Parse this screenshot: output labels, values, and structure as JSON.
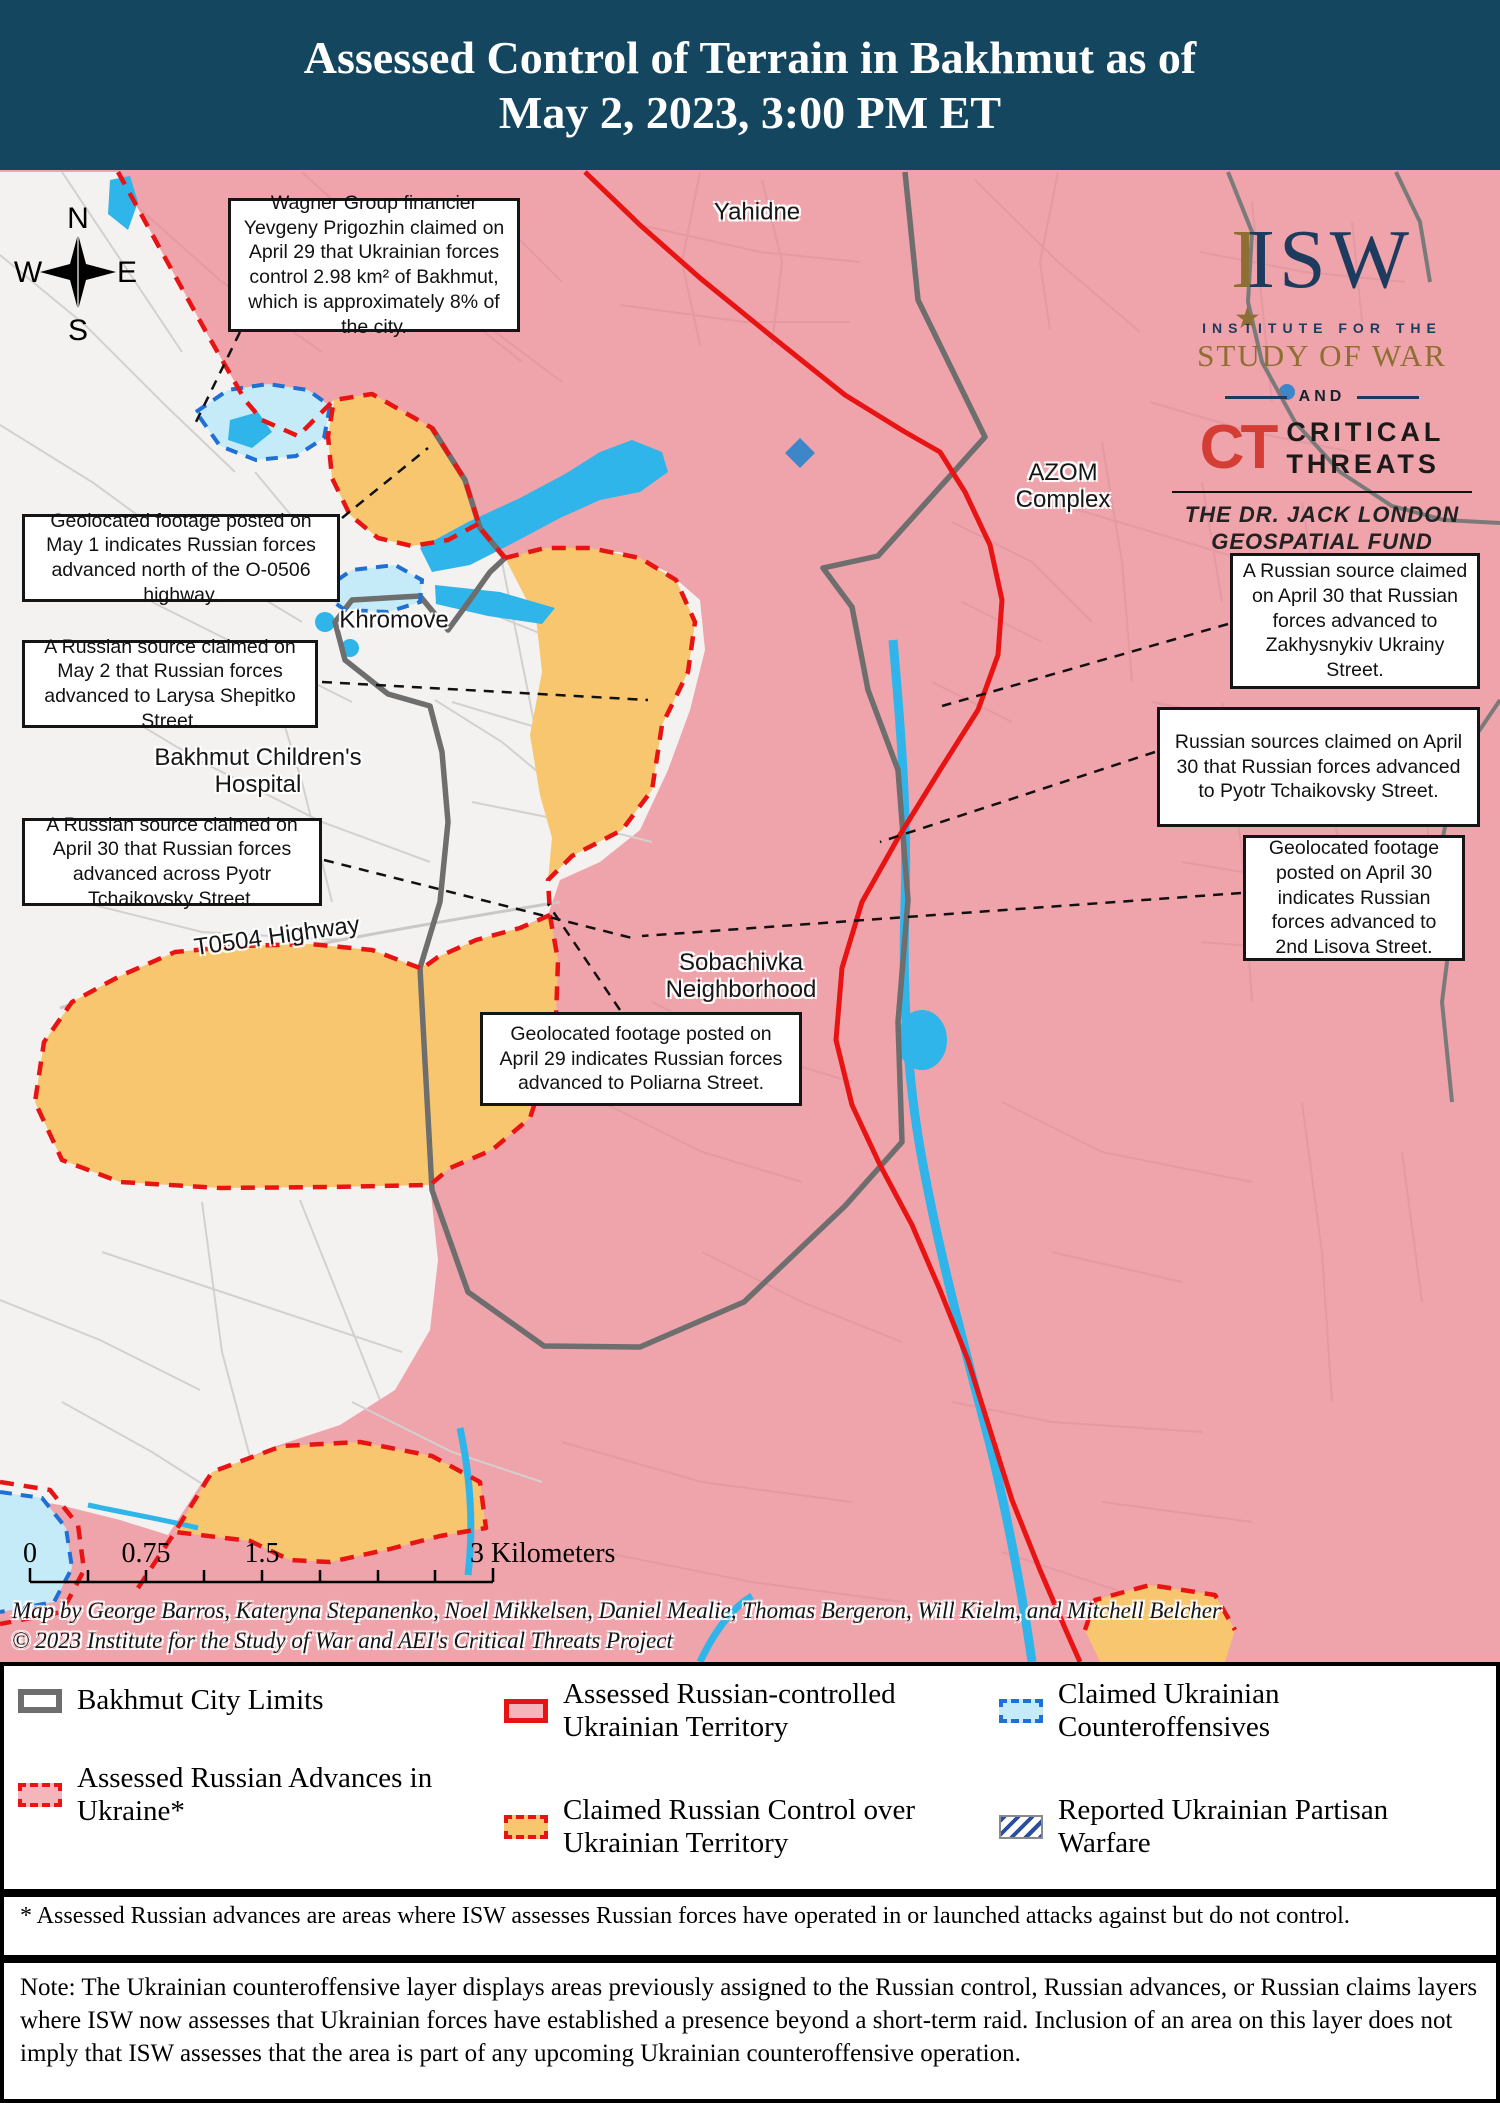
{
  "header": {
    "title_line1": "Assessed Control of Terrain in Bakhmut as of",
    "title_line2": "May 2, 2023, 3:00 PM ET"
  },
  "logo": {
    "isw_i": "I",
    "isw_sw": "ISW",
    "star": "★",
    "institute": "INSTITUTE FOR THE",
    "study_of_war": "STUDY OF WAR",
    "and": "AND",
    "ct": "CT",
    "critical": "CRITICAL",
    "threats": "THREATS",
    "fund_line1": "THE DR. JACK LONDON",
    "fund_line2": "GEOSPATIAL FUND"
  },
  "compass": {
    "north": "N",
    "south": "S",
    "east": "E",
    "west": "W"
  },
  "map": {
    "labels": {
      "yahidne": "Yahidne",
      "azom_line1": "AZOM",
      "azom_line2": "Complex",
      "khromove": "Khromove",
      "hospital_line1": "Bakhmut Children's",
      "hospital_line2": "Hospital",
      "t0504": "T0504 Highway",
      "sobachivka_line1": "Sobachivka",
      "sobachivka_line2": "Neighborhood"
    },
    "callouts": {
      "wagner": "Wagner Group financier Yevgeny Prigozhin claimed on April 29 that Ukrainian forces control 2.98 km² of Bakhmut, which is approximately 8% of the city.",
      "may1_o0506": "Geolocated footage posted on May 1 indicates Russian forces advanced north of the O-0506 highway.",
      "may2_shepitko": "A Russian source claimed on May 2 that Russian forces advanced to Larysa Shepitko Street.",
      "apr30_across_pyotr": "A Russian source claimed on April 30 that Russian forces advanced across Pyotr Tchaikovsky Street.",
      "apr30_zakhysnykiv": "A Russian source claimed on April 30 that Russian forces advanced to Zakhysnykiv Ukrainy Street.",
      "apr30_pyotr": "Russian sources claimed on April 30 that Russian forces advanced to Pyotr Tchaikovsky Street.",
      "apr30_lisova": "Geolocated footage posted on April 30 indicates Russian forces advanced to 2nd Lisova Street.",
      "apr29_poliarna": "Geolocated footage posted on April 29 indicates Russian forces advanced to Poliarna Street."
    },
    "scale": {
      "tick0": "0",
      "tick1": "0.75",
      "tick2": "1.5",
      "tick3": "3 Kilometers"
    },
    "credits_line1": "Map by George Barros, Kateryna Stepanenko, Noel Mikkelsen, Daniel Mealie, Thomas Bergeron, Will Kielm, and Mitchell Belcher",
    "credits_line2": "© 2023 Institute for the Study of War and AEI's Critical Threats Project"
  },
  "legend": {
    "items": [
      {
        "label": "Bakhmut City Limits"
      },
      {
        "label": "Assessed Russian Advances in Ukraine*"
      },
      {
        "label": "Assessed Russian-controlled Ukrainian Territory"
      },
      {
        "label": "Claimed Russian Control over Ukrainian Territory"
      },
      {
        "label": "Claimed Ukrainian Counteroffensives"
      },
      {
        "label": "Reported Ukrainian Partisan Warfare"
      }
    ]
  },
  "footnote": "* Assessed Russian advances are areas where ISW assesses Russian forces have operated in or launched attacks against but do not control.",
  "note": "Note: The Ukrainian counteroffensive layer displays areas previously assigned to the Russian control, Russian advances, or Russian claims layers where ISW now assesses that Ukrainian forces have established a presence beyond a short-term raid. Inclusion of an area on this layer does not imply that ISW assesses that the area is part of any upcoming Ukrainian counteroffensive operation.",
  "colors": {
    "header_bg": "#15465f",
    "russian_controlled_fill": "#efa3aa",
    "claimed_russian_fill": "#f8c66e",
    "contested_fill": "#f3f2f1",
    "counteroffensive_fill": "#c6ebf8",
    "counteroffensive_border": "#1f6fd4",
    "advance_red": "#e81414",
    "city_limits_gray": "#6e6e6e",
    "water_cyan": "#2fb5e9",
    "partisan_blue": "#2b4fa0",
    "isw_navy": "#1d3b5e",
    "isw_gold": "#8d7031",
    "ct_red": "#d43d33"
  }
}
